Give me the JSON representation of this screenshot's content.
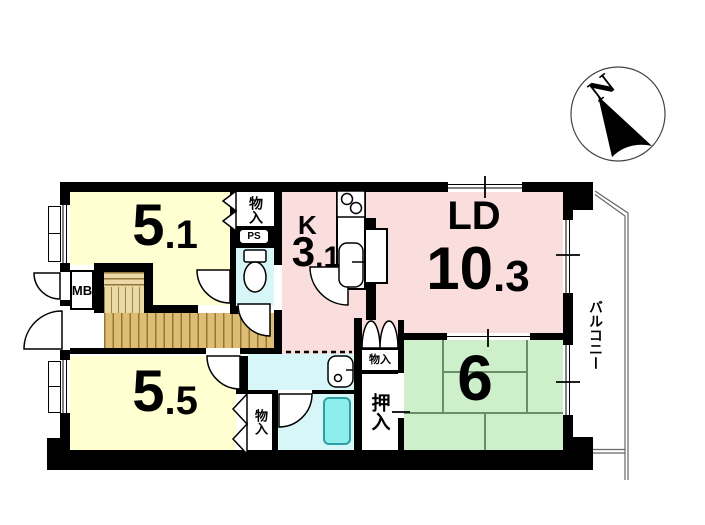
{
  "plan": {
    "rooms": {
      "western1": {
        "area_int": "5",
        "area_dec": ".1"
      },
      "western2": {
        "area_int": "5",
        "area_dec": ".5"
      },
      "kitchen": {
        "abbr": "K",
        "area_int": "3",
        "area_dec": ".1"
      },
      "living_dining": {
        "abbr": "LD",
        "area_int": "10",
        "area_dec": ".3"
      },
      "japanese": {
        "area": "6"
      }
    },
    "labels": {
      "balcony": "バルコニー",
      "closet_upper": "物入",
      "closet_lower": "物入",
      "closet_hall": "物入",
      "oshiire": "押入",
      "meter_box": "MB",
      "pipe_shaft": "PS"
    },
    "compass": {
      "north": "N"
    }
  },
  "colors": {
    "wall": "#000000",
    "western_room": "#ffffd2",
    "ld_kitchen": "#fadddd",
    "japanese_room": "#cdf0cb",
    "sanitary": "#d6f6f8",
    "bathtub": "#8eeeee",
    "flooring": "#dcbd72"
  }
}
